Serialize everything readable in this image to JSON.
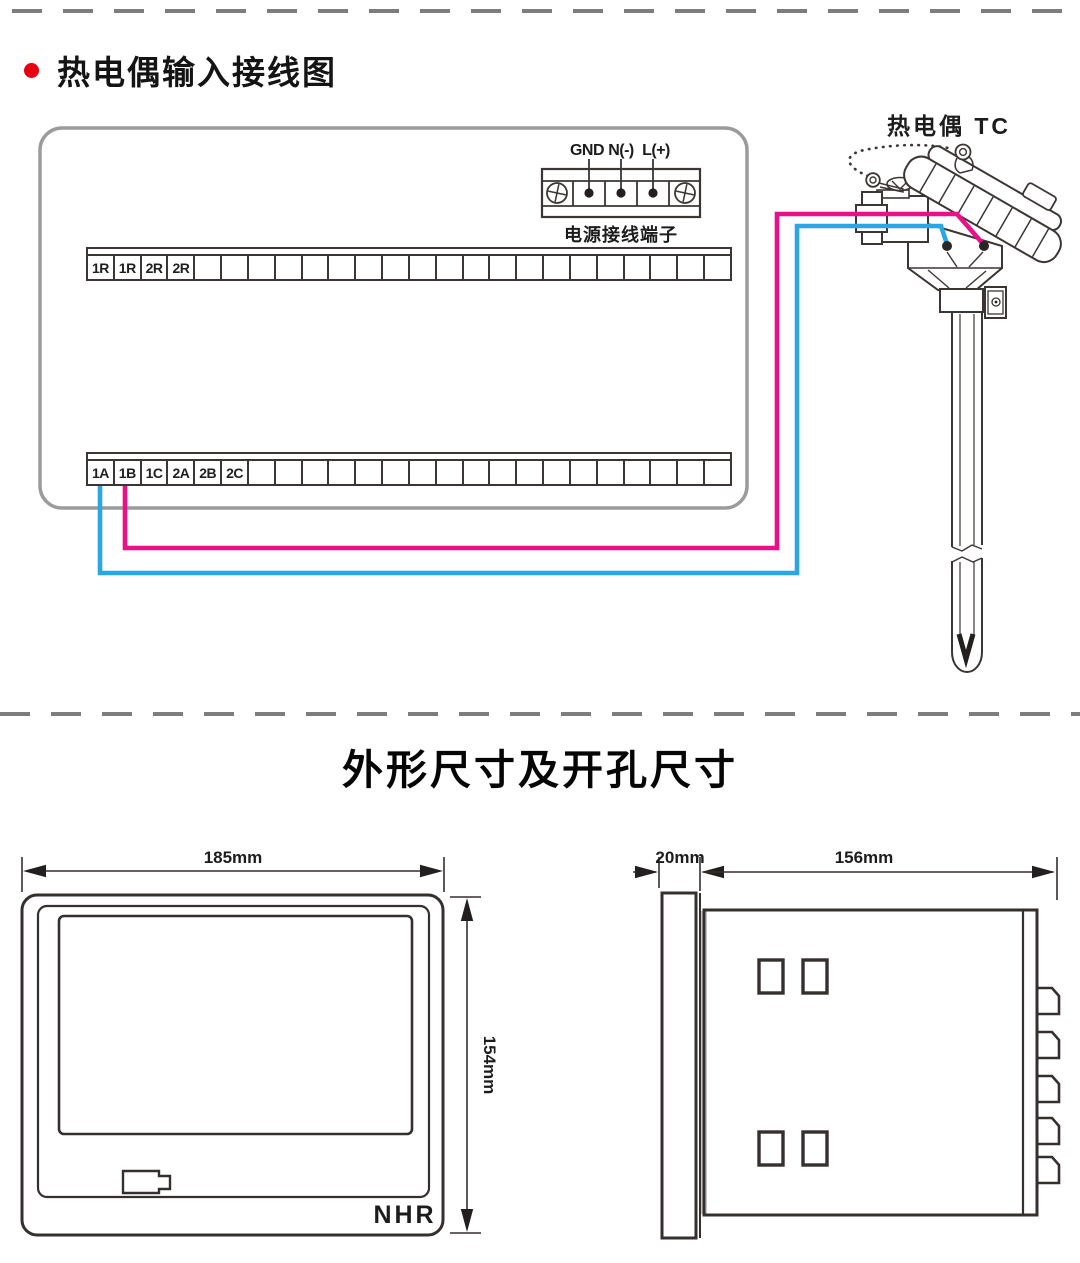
{
  "wiring": {
    "title": "热电偶输入接线图",
    "power": {
      "labels": [
        "GND",
        "N(-)",
        "L(+)"
      ],
      "caption": "电源接线端子"
    },
    "strips": {
      "top": {
        "cells": 24,
        "labels": [
          "1R",
          "1R",
          "2R",
          "2R"
        ]
      },
      "bottom": {
        "cells": 24,
        "labels": [
          "1A",
          "1B",
          "1C",
          "2A",
          "2B",
          "2C"
        ]
      }
    },
    "thermocouple": {
      "label": "热电偶 TC"
    },
    "wire_colors": {
      "positive_pink": "#ec0f8a",
      "negative_blue": "#29a7e2"
    }
  },
  "dimensions": {
    "title": "外形尺寸及开孔尺寸",
    "front_view": {
      "width_label": "185mm",
      "height_label": "154mm",
      "logo": {
        "n": "N",
        "h": "H",
        "r": "R"
      }
    },
    "side_view": {
      "depth_label": "20mm",
      "body_label": "156mm"
    }
  }
}
